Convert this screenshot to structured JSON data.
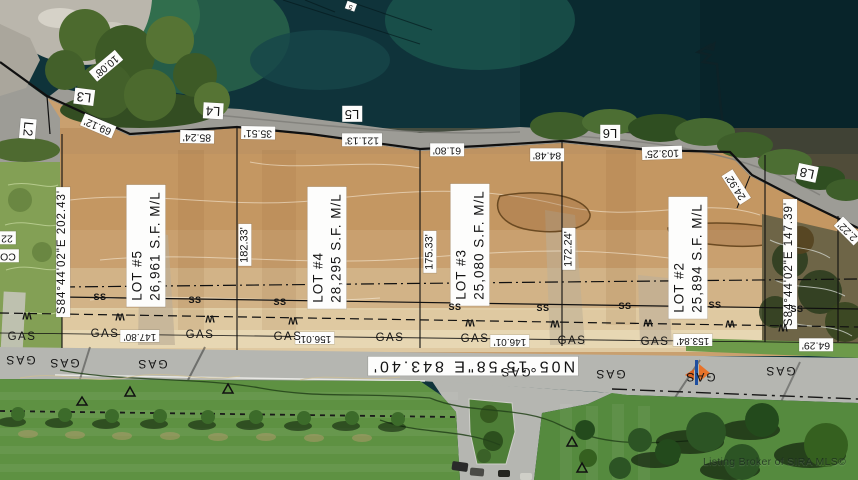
{
  "map_title": "Aerial plat map of lakefront building lots",
  "watermark": {
    "text": "Listing Broker of SIRA MLS©"
  },
  "colors": {
    "water": "#0f333a",
    "water_dark": "#082228",
    "water_green": "#2e6b4e",
    "shore_band": "#9d9c96",
    "dirt": "#c9a06f",
    "dirt_orange": "#bd8950",
    "hillside": "#83a055",
    "road": "#b5b6b1",
    "grass": "#5e9142",
    "label_bg": "#fdfdfc",
    "line": "#101010",
    "logo_orange": "#e8732a",
    "logo_blue": "#1f4fa0"
  },
  "lots": [
    {
      "name": "lot-5-label",
      "line1": "LOT #5",
      "line2": "26,961 S.F. M/L",
      "x": 146,
      "y": 246
    },
    {
      "name": "lot-4-label",
      "line1": "LOT #4",
      "line2": "28,295 S.F. M/L",
      "x": 327,
      "y": 248
    },
    {
      "name": "lot-3-label",
      "line1": "LOT #3",
      "line2": "25,080 S.F. M/L",
      "x": 470,
      "y": 245
    },
    {
      "name": "lot-2-label",
      "line1": "LOT #2",
      "line2": "25,894 S.F. M/L",
      "x": 688,
      "y": 258
    }
  ],
  "boxed_labels": [
    {
      "name": "dim-10-08",
      "text": "10.08'",
      "x": 106,
      "y": 66,
      "rot": 140,
      "fs": 10.5
    },
    {
      "name": "line-l2",
      "text": "L2",
      "x": 28,
      "y": 129,
      "rot": 95,
      "fs": 13
    },
    {
      "name": "line-l3",
      "text": "L3",
      "x": 84,
      "y": 97,
      "rot": 187,
      "fs": 13
    },
    {
      "name": "dim-69-12",
      "text": "69.12'",
      "x": 98,
      "y": 126,
      "rot": 203,
      "fs": 10.5
    },
    {
      "name": "line-l4",
      "text": "L4",
      "x": 213,
      "y": 111,
      "rot": 183,
      "fs": 13
    },
    {
      "name": "dim-85-24",
      "text": "85.24'",
      "x": 197,
      "y": 137,
      "rot": 181,
      "fs": 10.5
    },
    {
      "name": "dim-35-51",
      "text": "35.51'",
      "x": 258,
      "y": 133,
      "rot": 181,
      "fs": 10.5
    },
    {
      "name": "dim-121-13",
      "text": "121.13'",
      "x": 362,
      "y": 140,
      "rot": 180,
      "fs": 10.5
    },
    {
      "name": "line-l5",
      "text": "L5",
      "x": 352,
      "y": 114,
      "rot": 180,
      "fs": 13
    },
    {
      "name": "dim-61-80",
      "text": "61.80'",
      "x": 447,
      "y": 150,
      "rot": 180,
      "fs": 10.5
    },
    {
      "name": "dim-84-48",
      "text": "84.48'",
      "x": 547,
      "y": 155,
      "rot": 180,
      "fs": 10.5
    },
    {
      "name": "line-l6",
      "text": "L6",
      "x": 610,
      "y": 133,
      "rot": 180,
      "fs": 13
    },
    {
      "name": "dim-103-25",
      "text": "103.25'",
      "x": 662,
      "y": 153,
      "rot": 178,
      "fs": 10.5
    },
    {
      "name": "dim-24-92",
      "text": "24.92'",
      "x": 736,
      "y": 187,
      "rot": 237,
      "fs": 10.5
    },
    {
      "name": "line-l8",
      "text": "L8",
      "x": 807,
      "y": 173,
      "rot": 192,
      "fs": 13
    },
    {
      "name": "bearing-left",
      "text": "S84°44'02\"E  202.43'",
      "x": 63,
      "y": 252,
      "rot": -90,
      "fs": 11.5,
      "ls": 1
    },
    {
      "name": "bearing-right",
      "text": "S84°44'02\"E  147.39'",
      "x": 790,
      "y": 264,
      "rot": -90,
      "fs": 11.5,
      "ls": 1
    },
    {
      "name": "dim-64-29",
      "text": "64.29'",
      "x": 816,
      "y": 345,
      "rot": 180,
      "fs": 10.5
    },
    {
      "name": "dim-22-right-partial",
      "text": "2.22'",
      "x": 848,
      "y": 231,
      "rot": 225,
      "fs": 10.5
    },
    {
      "name": "dim-147-80",
      "text": "147.80'",
      "x": 140,
      "y": 336,
      "rot": 180,
      "fs": 10
    },
    {
      "name": "dim-156-01",
      "text": "156.01'",
      "x": 315,
      "y": 338,
      "rot": 180,
      "fs": 10
    },
    {
      "name": "dim-146-01",
      "text": "146.01'",
      "x": 510,
      "y": 341,
      "rot": 180,
      "fs": 10
    },
    {
      "name": "dim-153-84",
      "text": "153.84'",
      "x": 693,
      "y": 340,
      "rot": 180,
      "fs": 10
    },
    {
      "name": "dim-182-33",
      "text": "182.33'",
      "x": 245,
      "y": 245,
      "rot": -90,
      "fs": 11
    },
    {
      "name": "dim-175-33",
      "text": "175.33'",
      "x": 430,
      "y": 252,
      "rot": -90,
      "fs": 11
    },
    {
      "name": "dim-172-24",
      "text": "172.24'",
      "x": 569,
      "y": 249,
      "rot": -90,
      "fs": 11
    },
    {
      "name": "road-bearing",
      "text": "N05°15'58\"E  843.40'",
      "x": 473,
      "y": 366,
      "rot": 180,
      "fs": 16,
      "ls": 3
    },
    {
      "name": "label-22-left-partial",
      "text": "22",
      "x": 7,
      "y": 238,
      "rot": 180,
      "fs": 10.5
    },
    {
      "name": "label-co-left-partial",
      "text": "CO",
      "x": 8,
      "y": 256,
      "rot": 180,
      "fs": 10.5
    },
    {
      "name": "tiny-structure-label",
      "text": "5",
      "x": 351,
      "y": 6,
      "rot": 200,
      "fs": 7
    }
  ],
  "gas_line_labels": [
    {
      "text": "GAS",
      "x": 22,
      "y": 337
    },
    {
      "text": "GAS",
      "x": 105,
      "y": 334
    },
    {
      "text": "GAS",
      "x": 200,
      "y": 335
    },
    {
      "text": "GAS",
      "x": 288,
      "y": 337
    },
    {
      "text": "GAS",
      "x": 390,
      "y": 338
    },
    {
      "text": "GAS",
      "x": 475,
      "y": 339
    },
    {
      "text": "GAS",
      "x": 572,
      "y": 341
    },
    {
      "text": "GAS",
      "x": 655,
      "y": 342
    }
  ],
  "road_gas_labels": [
    {
      "text": "GAS",
      "x": 20,
      "y": 360
    },
    {
      "text": "GAS",
      "x": 64,
      "y": 363
    },
    {
      "text": "GAS",
      "x": 152,
      "y": 364
    },
    {
      "text": "GAS",
      "x": 515,
      "y": 372
    },
    {
      "text": "GAS",
      "x": 610,
      "y": 374
    },
    {
      "text": "GAS",
      "x": 700,
      "y": 377
    },
    {
      "text": "GAS",
      "x": 780,
      "y": 371
    }
  ],
  "sewer_labels": [
    {
      "text": "SS",
      "x": 100,
      "y": 297
    },
    {
      "text": "SS",
      "x": 195,
      "y": 300
    },
    {
      "text": "SS",
      "x": 280,
      "y": 302
    },
    {
      "text": "SS",
      "x": 455,
      "y": 307
    },
    {
      "text": "SS",
      "x": 543,
      "y": 308
    },
    {
      "text": "SS",
      "x": 625,
      "y": 306
    },
    {
      "text": "SS",
      "x": 715,
      "y": 305
    },
    {
      "text": "SS",
      "x": 797,
      "y": 309
    }
  ],
  "waterline_labels": [
    {
      "text": "W",
      "x": 27,
      "y": 315
    },
    {
      "text": "W",
      "x": 120,
      "y": 316
    },
    {
      "text": "W",
      "x": 210,
      "y": 318
    },
    {
      "text": "W",
      "x": 293,
      "y": 320
    },
    {
      "text": "W",
      "x": 470,
      "y": 322
    },
    {
      "text": "W",
      "x": 555,
      "y": 323
    },
    {
      "text": "W",
      "x": 648,
      "y": 322
    },
    {
      "text": "W",
      "x": 730,
      "y": 323
    },
    {
      "text": "W",
      "x": 783,
      "y": 327
    }
  ]
}
